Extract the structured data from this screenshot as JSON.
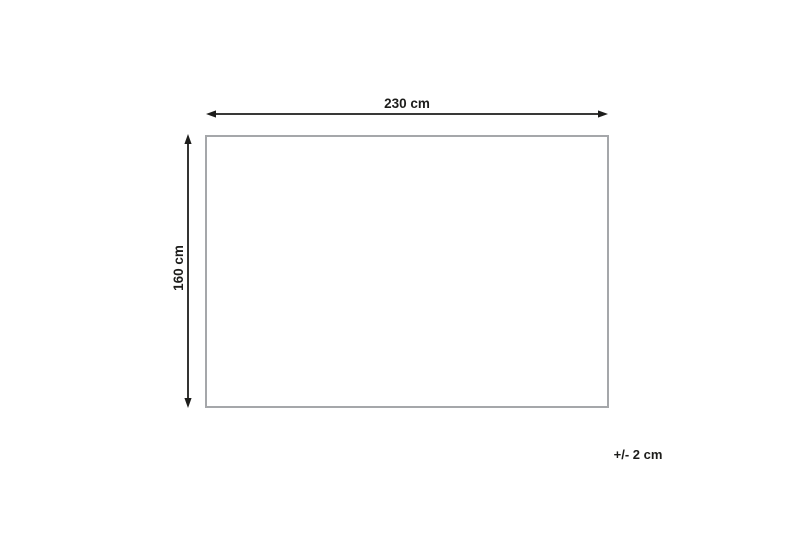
{
  "diagram": {
    "width_label": "230 cm",
    "height_label": "160 cm",
    "tolerance_label": "+/- 2 cm"
  },
  "icons": {
    "width_arrow": "double-headed-horizontal-arrow",
    "height_arrow": "double-headed-vertical-arrow"
  },
  "colors": {
    "arrow": "#1d1d1b",
    "text": "#1d1d1b",
    "rectangle_border": "#a5a7aa",
    "background": "#ffffff"
  }
}
